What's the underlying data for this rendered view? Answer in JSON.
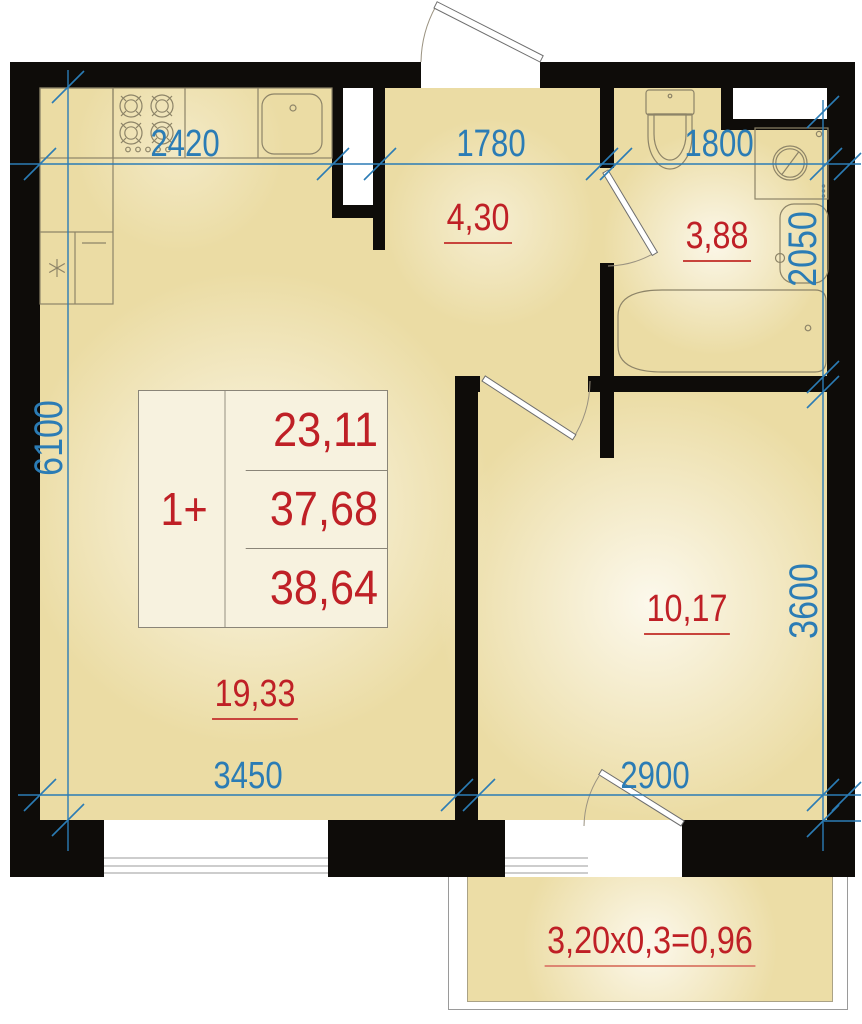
{
  "colors": {
    "wall": "#0e0c09",
    "dimension_blue": "#2b7cb5",
    "area_red": "#bf2026",
    "room_fill": "#ebdca4"
  },
  "unit_card": {
    "type": "1+",
    "area_rows": [
      "23,11",
      "37,68",
      "38,64"
    ]
  },
  "room_areas": {
    "hall": "4,30",
    "bathroom": "3,88",
    "living_kitchen": "19,33",
    "bedroom": "10,17"
  },
  "balcony": {
    "formula": "3,20x0,3=0,96"
  },
  "dimensions": {
    "kitchen_width": "2420",
    "hall_width": "1780",
    "bath_width": "1800",
    "bath_depth": "2050",
    "apartment_height": "6100",
    "bedroom_height": "3600",
    "living_width": "3450",
    "bedroom_width": "2900"
  }
}
